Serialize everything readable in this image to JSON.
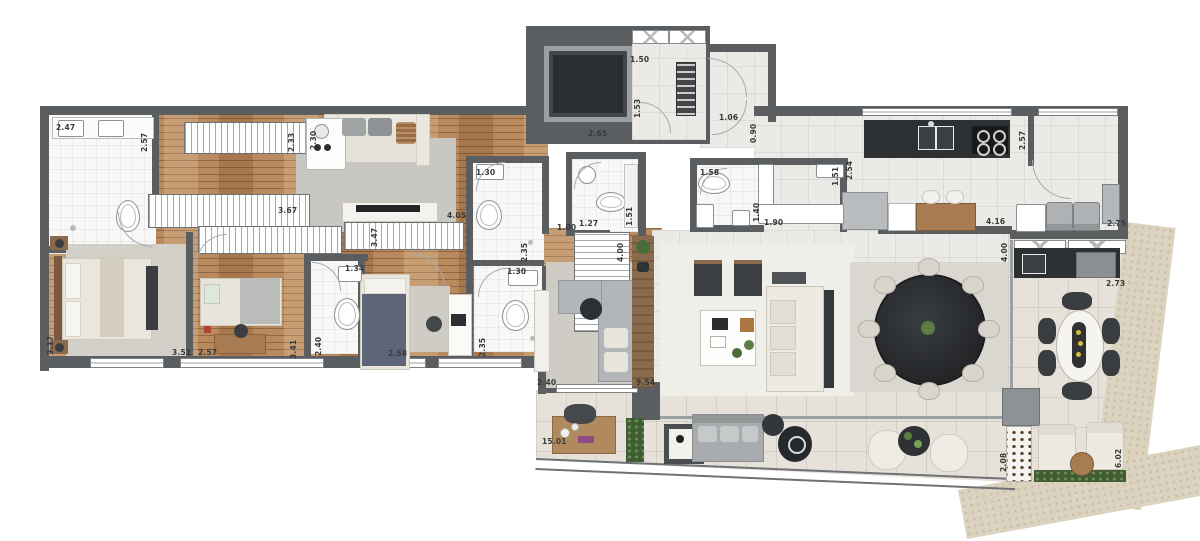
{
  "plan_type": "apartment-floor-plan",
  "colors": {
    "wall": "#5a5e61",
    "wood_floor": "#b98a5d",
    "tile_social": "#eceae6",
    "tile_terrace": "#e6e2d9",
    "bath_floor": "#f8f8f7",
    "stone_border": "#dbd3bf",
    "dark_furniture": "#2e3134",
    "sofa_beige": "#eae6dc",
    "sofa_gray": "#b3b6b8",
    "rug_gray": "#cfccc6",
    "greenery": "#4a6b3a",
    "label_text": "#38393a"
  },
  "dimension_labels": [
    {
      "text": "2.47",
      "x": 56,
      "y": 124,
      "rot": 0
    },
    {
      "text": "2.57",
      "x": 141,
      "y": 152,
      "rot": 90
    },
    {
      "text": "2.33",
      "x": 288,
      "y": 152,
      "rot": 90
    },
    {
      "text": "2.30",
      "x": 310,
      "y": 150,
      "rot": 90
    },
    {
      "text": "3.67",
      "x": 278,
      "y": 207,
      "rot": 0
    },
    {
      "text": "3.47",
      "x": 371,
      "y": 247,
      "rot": 90
    },
    {
      "text": "4.05",
      "x": 447,
      "y": 212,
      "rot": 0
    },
    {
      "text": "1.30",
      "x": 476,
      "y": 169,
      "rot": 0
    },
    {
      "text": "2.35",
      "x": 521,
      "y": 262,
      "rot": 90
    },
    {
      "text": "1.30",
      "x": 507,
      "y": 268,
      "rot": 0
    },
    {
      "text": "2.35",
      "x": 479,
      "y": 357,
      "rot": 90
    },
    {
      "text": "1.34",
      "x": 345,
      "y": 265,
      "rot": 0
    },
    {
      "text": "2.40",
      "x": 315,
      "y": 356,
      "rot": 90
    },
    {
      "text": "2.57",
      "x": 198,
      "y": 349,
      "rot": 0
    },
    {
      "text": "3.41",
      "x": 290,
      "y": 359,
      "rot": 90
    },
    {
      "text": "3.51",
      "x": 172,
      "y": 349,
      "rot": 0
    },
    {
      "text": "3.17",
      "x": 47,
      "y": 355,
      "rot": 90
    },
    {
      "text": "2.58",
      "x": 388,
      "y": 350,
      "rot": 0
    },
    {
      "text": "2.40",
      "x": 537,
      "y": 379,
      "rot": 0
    },
    {
      "text": "9.54",
      "x": 636,
      "y": 379,
      "rot": 0
    },
    {
      "text": "4.00",
      "x": 617,
      "y": 262,
      "rot": 90
    },
    {
      "text": "1.00",
      "x": 557,
      "y": 224,
      "rot": 0
    },
    {
      "text": "1.27",
      "x": 579,
      "y": 220,
      "rot": 0
    },
    {
      "text": "1.51",
      "x": 626,
      "y": 226,
      "rot": 90
    },
    {
      "text": "1.50",
      "x": 630,
      "y": 56,
      "rot": 0
    },
    {
      "text": "1.53",
      "x": 634,
      "y": 118,
      "rot": 90
    },
    {
      "text": "2.65",
      "x": 588,
      "y": 130,
      "rot": 0
    },
    {
      "text": "1.06",
      "x": 719,
      "y": 114,
      "rot": 0
    },
    {
      "text": "0.90",
      "x": 750,
      "y": 143,
      "rot": 90
    },
    {
      "text": "1.58",
      "x": 700,
      "y": 169,
      "rot": 0
    },
    {
      "text": "1.40",
      "x": 753,
      "y": 222,
      "rot": 90
    },
    {
      "text": "1.90",
      "x": 764,
      "y": 219,
      "rot": 0
    },
    {
      "text": "1.51",
      "x": 832,
      "y": 186,
      "rot": 90
    },
    {
      "text": "2.54",
      "x": 846,
      "y": 180,
      "rot": 90
    },
    {
      "text": "4.16",
      "x": 986,
      "y": 218,
      "rot": 0
    },
    {
      "text": "2.57",
      "x": 1019,
      "y": 150,
      "rot": 90
    },
    {
      "text": "2.75",
      "x": 1107,
      "y": 220,
      "rot": 0
    },
    {
      "text": "4.00",
      "x": 1001,
      "y": 262,
      "rot": 90
    },
    {
      "text": "2.73",
      "x": 1106,
      "y": 280,
      "rot": 0
    },
    {
      "text": "2.08",
      "x": 1000,
      "y": 472,
      "rot": 90
    },
    {
      "text": "6.02",
      "x": 1115,
      "y": 468,
      "rot": 90
    },
    {
      "text": "15.01",
      "x": 542,
      "y": 438,
      "rot": 0
    }
  ]
}
